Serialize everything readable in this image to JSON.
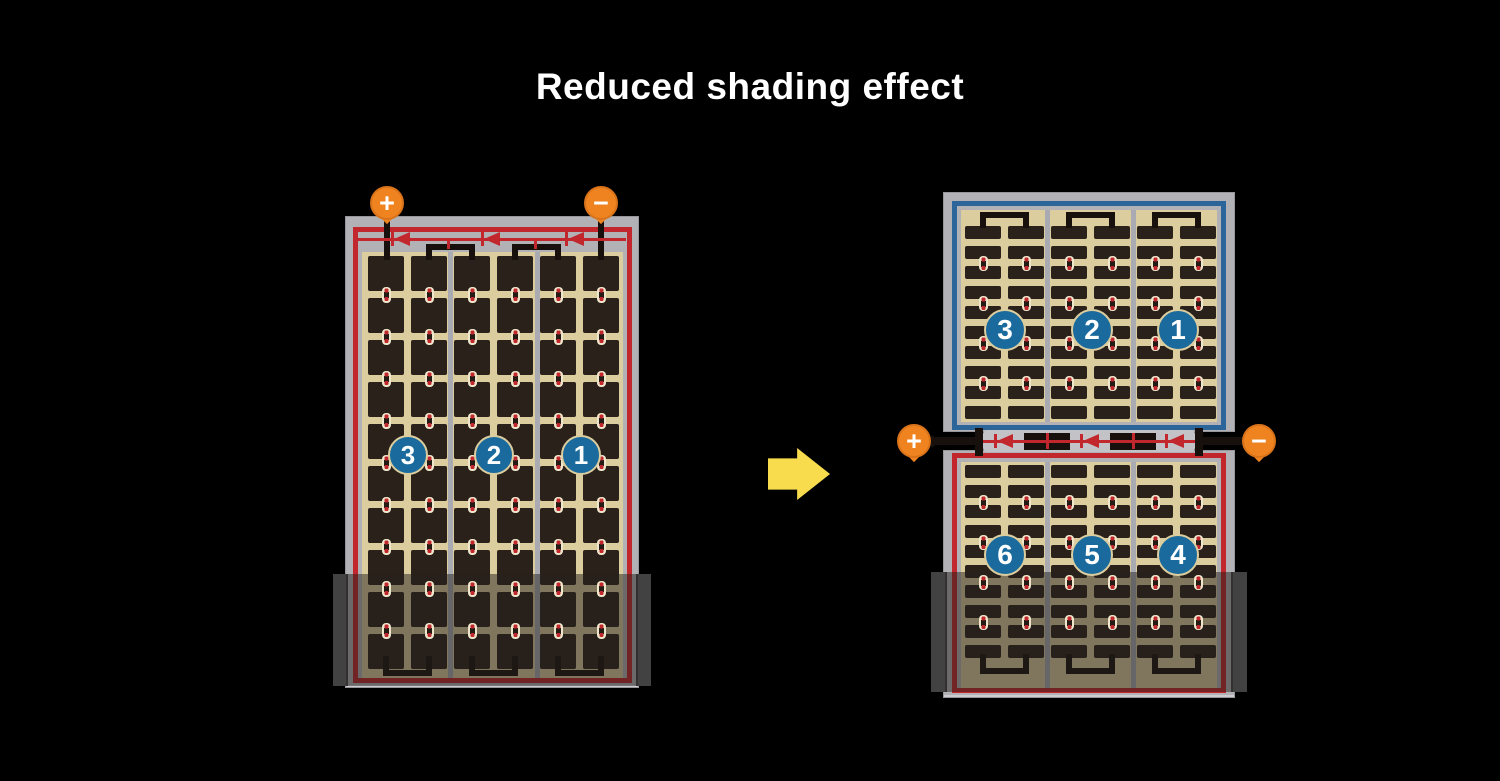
{
  "title": "Reduced shading effect",
  "terminals": {
    "plus_label": "+",
    "minus_label": "−"
  },
  "left_panel": {
    "description": "full-cell module, single series string with top bypass diodes",
    "section_labels": [
      "3",
      "2",
      "1"
    ]
  },
  "right_panel": {
    "description": "half-cut cell module, split into top and bottom halves with center junction box",
    "top_section_labels": [
      "3",
      "2",
      "1"
    ],
    "bottom_section_labels": [
      "6",
      "5",
      "4"
    ]
  },
  "icons": {
    "arrow": "right-arrow",
    "diode": "left-pointing-diode",
    "shading": "semi-transparent-shadow-band"
  },
  "colors": {
    "background": "#000000",
    "title_text": "#ffffff",
    "panel_frame": "#b2b2b6",
    "frame_edge": "#97979b",
    "cell_tan": "#dbcd9e",
    "cell_dark": "#2b211b",
    "divider_gray": "#a9aab2",
    "string_red": "#c1272d",
    "string_blue": "#2b6599",
    "wire_black": "#17100c",
    "terminal_orange": "#ef8320",
    "number_circle_blue": "#1a6a9d",
    "junction_gray": "#c3c3c7",
    "arrow_yellow": "#f8dc4e",
    "shade_wing": "#424242",
    "shade_body": "rgba(35,31,27,0.5)"
  }
}
